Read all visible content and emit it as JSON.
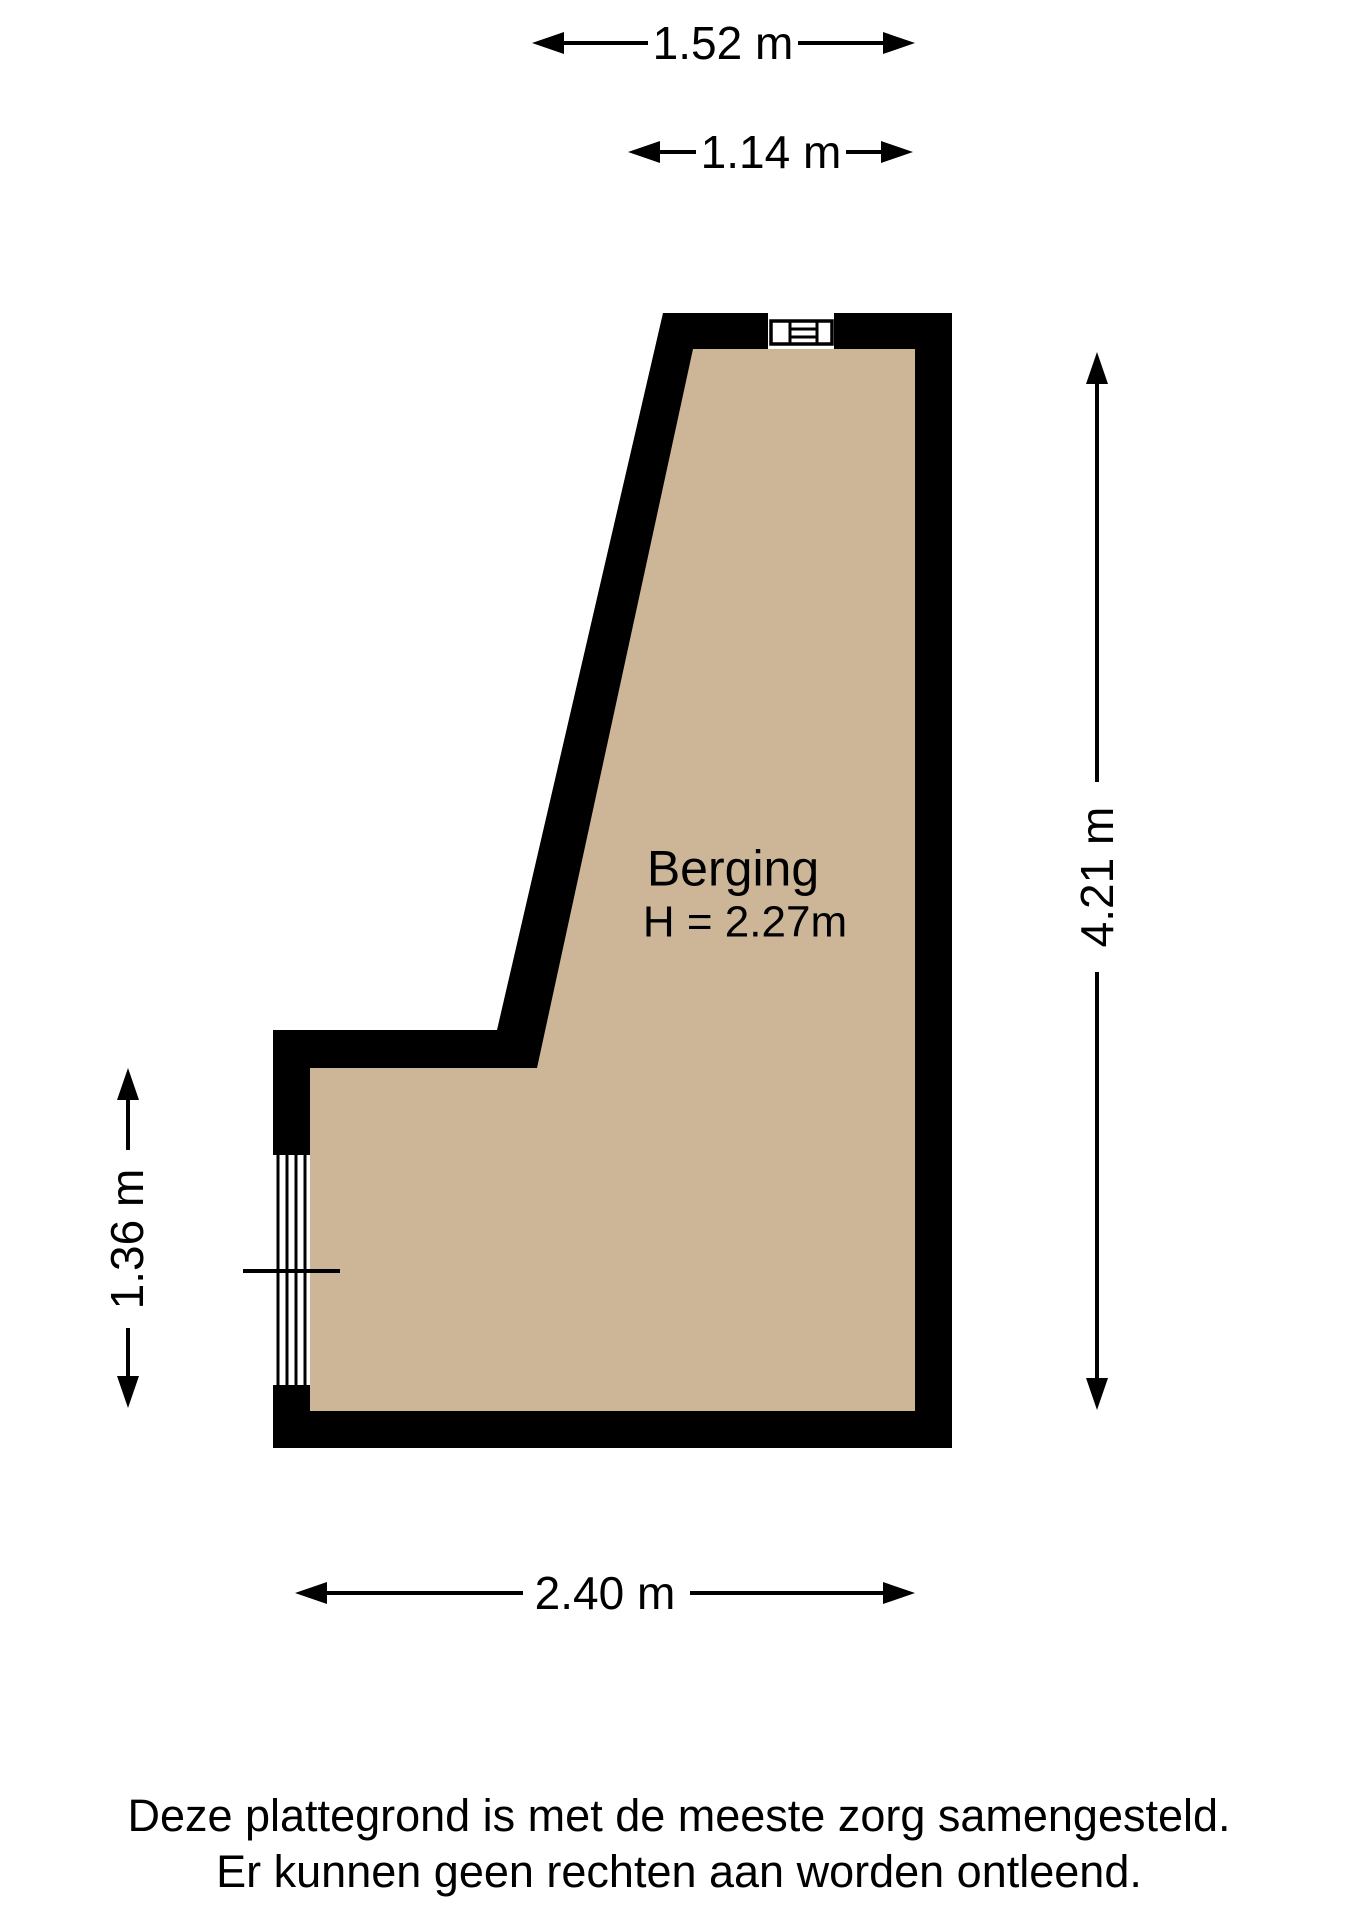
{
  "floorplan": {
    "room": {
      "name": "Berging",
      "height_label": "H = 2.27m"
    },
    "dimensions": {
      "top_outer": "1.52 m",
      "top_inner": "1.14 m",
      "right": "4.21 m",
      "left": "1.36 m",
      "bottom": "2.40 m"
    },
    "colors": {
      "wall": "#000000",
      "floor": "#CCB697",
      "background": "#FFFFFF"
    },
    "disclaimer": {
      "line1": "Deze plattegrond is met de meeste zorg samengesteld.",
      "line2": "Er kunnen geen rechten aan worden ontleend."
    }
  }
}
